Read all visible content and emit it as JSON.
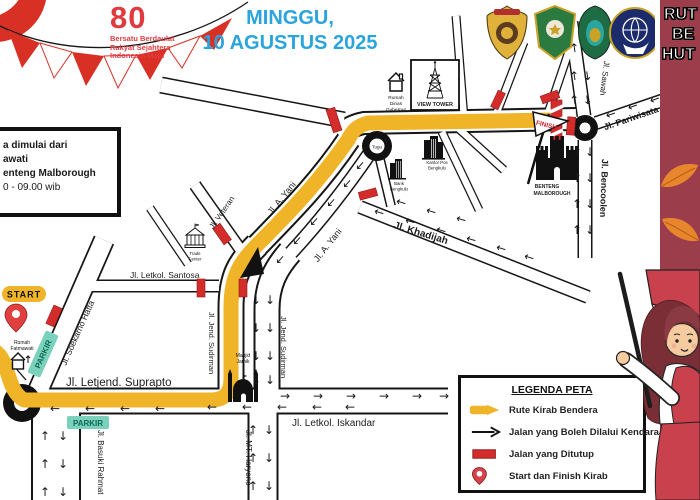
{
  "header": {
    "anniversary": {
      "number": "80",
      "tagline": [
        "Bersatu Berdaulat",
        "Rakyat Sejahtera",
        "Indonesia Maju"
      ]
    },
    "day": "MINGGU,",
    "date": "10 AGUSTUS 2025",
    "logos": [
      "police-badge",
      "province-shield",
      "city-shield",
      "transport-ministry-emblem"
    ]
  },
  "side_banner": {
    "lines": [
      "RUT",
      "BE",
      "HUT"
    ]
  },
  "info_box": {
    "lines": [
      "a dimulai dari",
      "awati",
      "enteng Malborough",
      "0 - 09.00 wib"
    ]
  },
  "map": {
    "start_label": "START",
    "finish_label": "FINISH",
    "parkir_label": "PARKIR",
    "streets": {
      "suprapto": "Jl. Letjend. Suprapto",
      "iskandar": "Jl. Letkol. Iskandar",
      "basuki_rahmat": "Jl. Basuki Rahmat",
      "mt_haryono": "Jl. MT. Haryono",
      "soekarno_hatta": "Jl. Soekarno Hatta",
      "sudirman": "Jl. Jend. Sudirman",
      "santosa": "Jl. Letkol. Santosa",
      "veteran": "Jl. Veteran",
      "a_yani": "Jl. A. Yani",
      "khadijah": "Jl. Khadijah",
      "sawah": "Jl. Sawah",
      "pariwisata": "Jl. Pariwisata",
      "bencoolen": "Jl. Bencoolen"
    },
    "places": {
      "rumah_fatmawati": [
        "Rumah",
        "Fatmawati"
      ],
      "rumah_dinas_gubernur": [
        "Rumah",
        "Dinas",
        "Gubernur"
      ],
      "view_tower": "VIEW TOWER",
      "benteng_malborough": [
        "BENTENG",
        "MALBOROUGH"
      ],
      "masjid": [
        "Masjid",
        "Jamik"
      ],
      "tugu": "Tugu",
      "kantor_pos": [
        "Kantor Pos",
        "Bengkulu"
      ],
      "bank": [
        "Bank",
        "Bengkulu"
      ],
      "trade_center": [
        "Trade",
        "Center"
      ]
    }
  },
  "legend": {
    "title": "LEGENDA PETA",
    "items": [
      {
        "icon": "route-arrow",
        "label": "Rute Kirab Bendera"
      },
      {
        "icon": "allowed-arrow",
        "label": "Jalan yang Boleh Dilalui Kendaraan"
      },
      {
        "icon": "closed-road",
        "label": "Jalan yang Ditutup"
      },
      {
        "icon": "start-finish-pin",
        "label": "Start dan Finish Kirab"
      }
    ]
  },
  "colors": {
    "route_yellow": "#F0B429",
    "closed_red": "#D42B2B",
    "banner_red": "#9C3D4B",
    "date_blue": "#2AA4DC",
    "parkir_teal": "#7CD1BD"
  }
}
